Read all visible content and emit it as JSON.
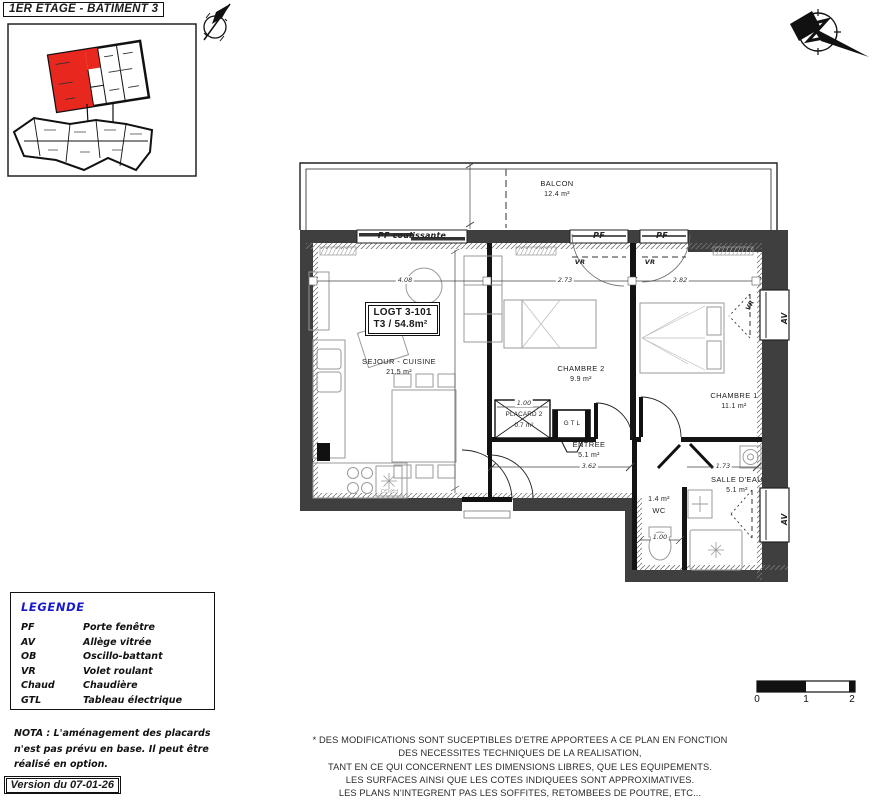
{
  "header": {
    "title": "1ER ETAGE - BATIMENT 3"
  },
  "unit": {
    "id": "LOGT 3-101",
    "type": "T3 / 54.8m²"
  },
  "rooms": {
    "balcon": {
      "name": "BALCON",
      "area": "12.4 m²"
    },
    "sejour": {
      "name": "SEJOUR - CUISINE",
      "area": "21.5 m²"
    },
    "chambre2": {
      "name": "CHAMBRE 2",
      "area": "9.9 m²"
    },
    "chambre1": {
      "name": "CHAMBRE 1",
      "area": "11.1 m²"
    },
    "entree": {
      "name": "ENTREE",
      "area": "5.1 m²"
    },
    "placard": {
      "name": "PLACARD 2",
      "area": "0.7 m²"
    },
    "wc": {
      "name": "WC",
      "area": "1.4 m²"
    },
    "salle_eau": {
      "name": "SALLE D'EAU",
      "area": "5.1 m²"
    },
    "gtl": {
      "name": "G T L"
    }
  },
  "annotations": {
    "pf_coulissante": "PF coulissante",
    "pf": "PF",
    "vr": "VR",
    "av": "AV",
    "frigo": "FRIGO"
  },
  "dimensions": {
    "sejour_w": "4.08",
    "chambre2_w": "2.73",
    "chambre1_w": "2.82",
    "entree_w": "3.62",
    "salle_eau_w": "1.73",
    "wc_w": "1.00",
    "placard_w": "1.00"
  },
  "legend": {
    "title": "LEGENDE",
    "rows": [
      {
        "abbr": "PF",
        "label": "Porte fenêtre"
      },
      {
        "abbr": "AV",
        "label": "Allège vitrée"
      },
      {
        "abbr": "OB",
        "label": "Oscillo-battant"
      },
      {
        "abbr": "VR",
        "label": "Volet roulant"
      },
      {
        "abbr": "Chaud",
        "label": "Chaudière"
      },
      {
        "abbr": "GTL",
        "label": "Tableau électrique"
      }
    ]
  },
  "nota": {
    "line1": "NOTA : L'aménagement des placards",
    "line2": "n'est pas prévu en base. Il peut être",
    "line3": "réalisé en option."
  },
  "version": "Version du 07-01-26",
  "disclaimer": {
    "lines": [
      "* DES MODIFICATIONS SONT SUCEPTIBLES D'ETRE APPORTEES A CE PLAN EN FONCTION",
      "DES NECESSITES TECHNIQUES DE LA REALISATION,",
      "TANT EN CE QUI CONCERNENT LES DIMENSIONS LIBRES, QUE LES EQUIPEMENTS.",
      "LES SURFACES AINSI QUE LES COTES INDIQUEES SONT APPROXIMATIVES.",
      "LES PLANS N'INTEGRENT PAS LES SOFFITES, RETOMBEES DE POUTRE, ETC..."
    ]
  },
  "scalebar": {
    "t0": "0",
    "t1": "1",
    "t2": "2"
  },
  "colors": {
    "highlight_red": "#e8281e",
    "legend_blue": "#1a1acd",
    "wall_dark": "#3f3f3f"
  }
}
